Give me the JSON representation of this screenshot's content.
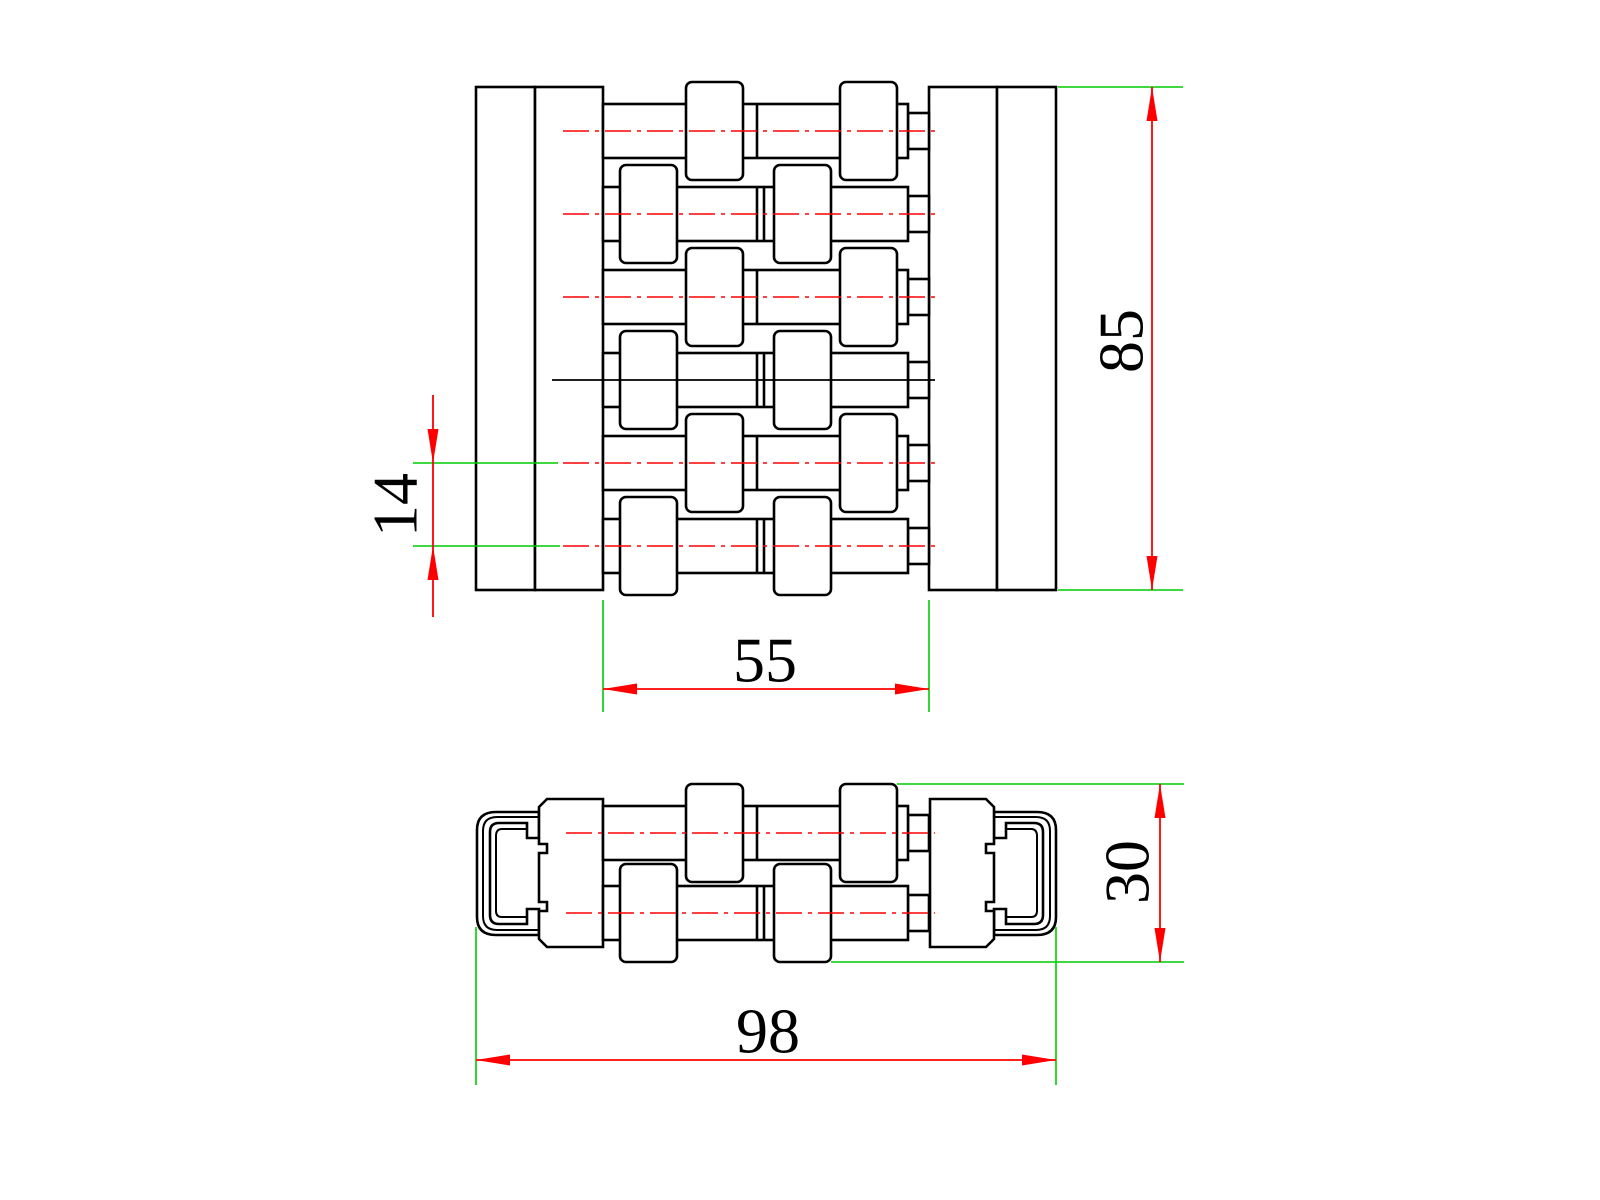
{
  "drawing": {
    "type": "engineering-cad-drawing",
    "background": "#ffffff",
    "colors": {
      "outline": "#000000",
      "dimension_line": "#ff0000",
      "extension_line": "#00cc00",
      "centerline": "#ff0000",
      "solid_centerline": "#000000"
    },
    "views": {
      "top_view": {
        "name": "top-view",
        "rows": 6
      },
      "front_view": {
        "name": "front-view",
        "rows": 2
      }
    },
    "dimensions": {
      "d85": {
        "label": "85",
        "orientation": "vertical"
      },
      "d14": {
        "label": "14",
        "orientation": "vertical"
      },
      "d55": {
        "label": "55",
        "orientation": "horizontal"
      },
      "d30": {
        "label": "30",
        "orientation": "vertical"
      },
      "d98": {
        "label": "98",
        "orientation": "horizontal"
      }
    }
  }
}
